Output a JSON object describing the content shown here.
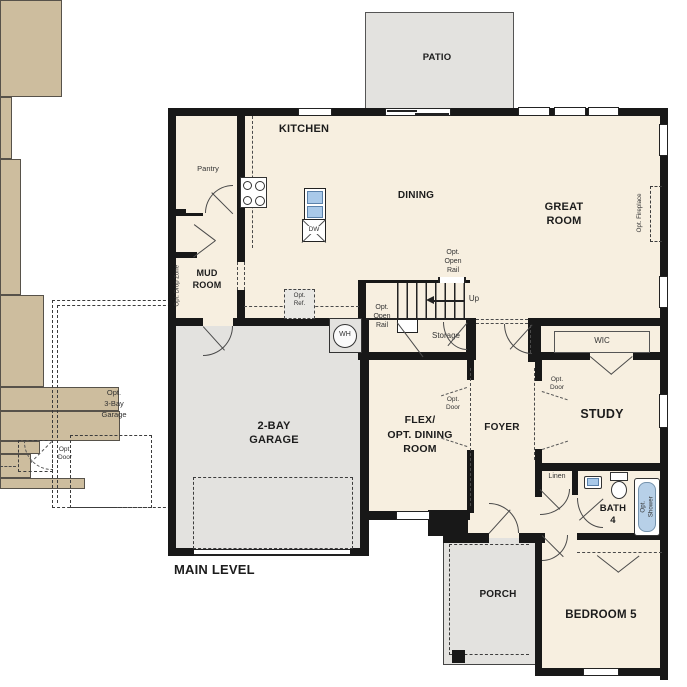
{
  "plan_title": "MAIN LEVEL",
  "colors": {
    "room_fill": "#f7efe0",
    "outdoor_fill": "#e3e2df",
    "cabinet_tan": "#cdbd9e",
    "wall": "#181818",
    "sink_blue": "#a9c9e9",
    "tub_blue": "#b7d0e8"
  },
  "labels": {
    "patio": "PATIO",
    "kitchen": "KITCHEN",
    "pantry": "Pantry",
    "dining": "DINING",
    "great_room": "GREAT\nROOM",
    "opt_fireplace": "Opt. Fireplace",
    "mud_room": "MUD\nROOM",
    "opt_drop_zone": "Opt. Drop Zone",
    "opt_ref": "Opt.\nRef.",
    "dishwasher": "DW",
    "water_heater": "WH",
    "up": "Up",
    "storage": "Storage",
    "opt_open_rail": "Opt.\nOpen\nRail",
    "garage_2bay": "2-BAY\nGARAGE",
    "garage_3bay_opt": "Opt.\n3-Bay\nGarage",
    "opt_door": "Opt.\nDoor",
    "flex_room": "FLEX/\nOPT. DINING\nROOM",
    "foyer": "FOYER",
    "wic": "WIC",
    "study": "STUDY",
    "linen": "Linen",
    "bath4": "BATH\n4",
    "opt_shower": "Opt.\nShower",
    "porch": "PORCH",
    "bedroom5": "BEDROOM 5",
    "main_level": "MAIN LEVEL"
  }
}
